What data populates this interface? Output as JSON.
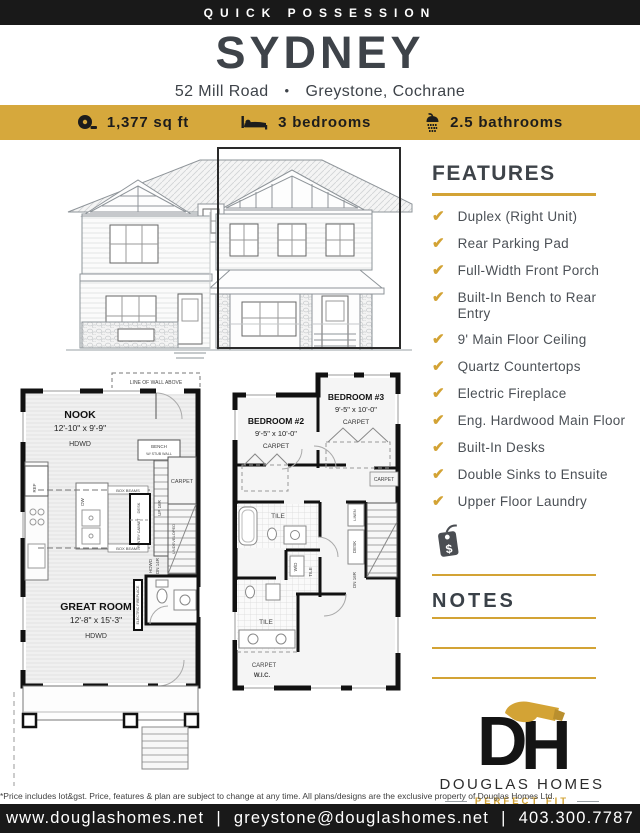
{
  "colors": {
    "gold": "#d6a83c",
    "gold_dark": "#d3a335",
    "charcoal": "#3e4349",
    "bar_black": "#191919"
  },
  "header": {
    "banner": "QUICK POSSESSION"
  },
  "title": {
    "name": "SYDNEY",
    "address_left": "52 Mill Road",
    "bullet": "•",
    "address_right": "Greystone, Cochrane"
  },
  "stats": {
    "items": [
      {
        "icon": "tape-measure-icon",
        "label": "1,377 sq ft"
      },
      {
        "icon": "bed-icon",
        "label": "3 bedrooms"
      },
      {
        "icon": "shower-icon",
        "label": "2.5 bathrooms"
      }
    ]
  },
  "features": {
    "heading": "FEATURES",
    "check_glyph": "✔",
    "items": [
      "Duplex (Right Unit)",
      "Rear Parking Pad",
      "Full-Width Front Porch",
      "Built-In Bench to Rear Entry",
      "9' Main Floor Ceiling",
      "Quartz Countertops",
      "Electric Fireplace",
      "Eng. Hardwood Main Floor",
      "Built-In Desks",
      "Double Sinks to Ensuite",
      "Upper Floor Laundry"
    ]
  },
  "price_tag": {
    "symbol": "$"
  },
  "notes": {
    "heading": "NOTES"
  },
  "floorplans": {
    "main_floor": {
      "wall_note": "LINE OF WALL ABOVE",
      "nook": {
        "name": "NOOK",
        "dims": "12'-10\" x 9'-9\"",
        "floor": "HDWD"
      },
      "great_room": {
        "name": "GREAT ROOM",
        "dims": "12'-8\" x 15'-3\"",
        "floor": "HDWD"
      },
      "bench_line1": "BENCH",
      "bench_line2": "W/ STUB WALL",
      "up_stairs": "UP 16R",
      "landing": "CARPET",
      "undeveloped": "UNDEVELOPED",
      "dn_floor": "HDWD",
      "dn_label": "DN 14R",
      "ref": "REF",
      "dw": "DW",
      "pantry": "PANTRY CABINET",
      "desk": "DESK",
      "box_beams": "BOX BEAMS",
      "fireplace": "ELECTRIC FIREPLACE"
    },
    "upper_floor": {
      "bedroom2": {
        "name": "BEDROOM #2",
        "dims": "9'-5\" x 10'-0\"",
        "floor": "CARPET"
      },
      "bedroom3": {
        "name": "BEDROOM #3",
        "dims": "9'-5\" x 10'-0\"",
        "floor": "CARPET"
      },
      "primary": {
        "name": "PRIMARY BEDROOM",
        "dims": "12'-4\" x 12'-6\"",
        "floor": "CARPET"
      },
      "bath_tile": "TILE",
      "ensuite_tile": "TILE",
      "laundry_tile": "TILE",
      "linen": "LINEN",
      "hall": "CARPET",
      "desk": "DESK",
      "dn_stairs": "DN 16R",
      "wd": "W/D",
      "wic_floor": "CARPET",
      "wic": "W.I.C."
    }
  },
  "logo": {
    "monogram_d": "D",
    "monogram_h": "H",
    "name": "DOUGLAS HOMES",
    "tagline": "PERFECT FIT"
  },
  "footer": {
    "disclaimer": "*Price includes lot&gst. Price, features & plan are subject to change at any time. All plans/designs are the exclusive property of Douglas Homes Ltd.",
    "website": "www.douglashomes.net",
    "email": "greystone@douglashomes.net",
    "phone": "403.300.7787",
    "separator": "|"
  }
}
